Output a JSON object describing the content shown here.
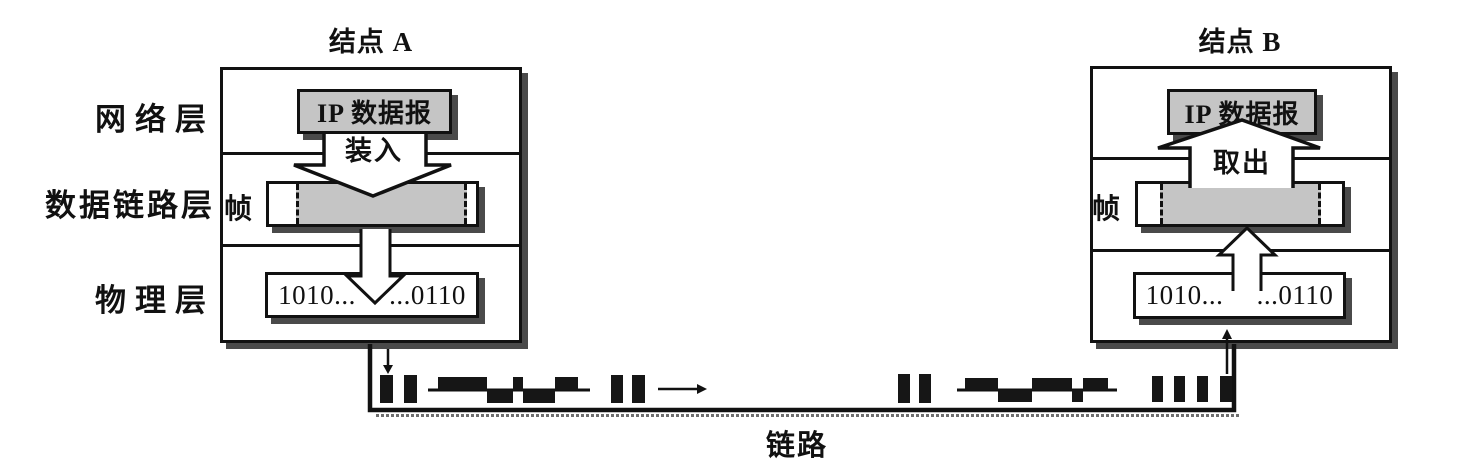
{
  "diagram": {
    "node_a": {
      "title": "结点 A",
      "ip_label": "IP 数据报",
      "action_label": "装入",
      "frame_label": "帧",
      "bits_label": "1010... ...0110"
    },
    "node_b": {
      "title": "结点 B",
      "ip_label": "IP 数据报",
      "action_label": "取出",
      "frame_label": "帧",
      "bits_label": "1010... ...0110"
    },
    "layer_labels": [
      "网络层",
      "数据链路层",
      "物理层"
    ],
    "link_label": "链路",
    "colors": {
      "ink": "#111111",
      "shade_fill": "#c5c5c5",
      "shadow": "#4a4a4a",
      "background": "#ffffff"
    }
  }
}
